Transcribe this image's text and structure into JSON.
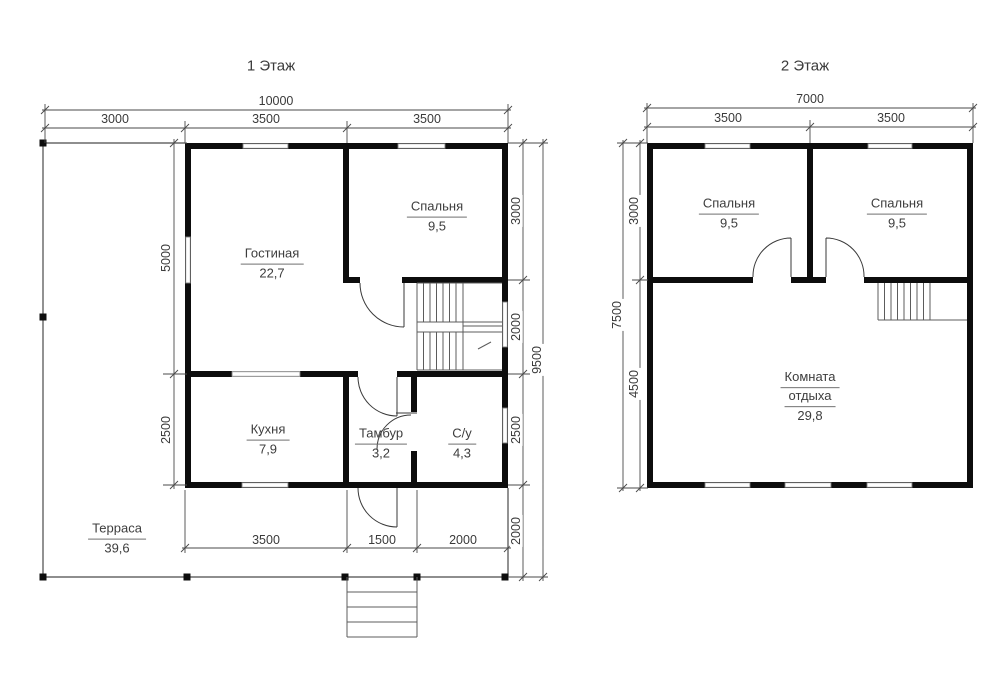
{
  "floor1": {
    "title": "1 Этаж",
    "dims": {
      "total_width": "10000",
      "segments_top": [
        "3000",
        "3500",
        "3500"
      ],
      "left": [
        "5000",
        "2500"
      ],
      "right": [
        "3000",
        "2000",
        "2500",
        "2000"
      ],
      "total_height": "9500",
      "segments_bottom": [
        "3500",
        "1500",
        "2000"
      ]
    },
    "rooms": {
      "living": {
        "name": "Гостиная",
        "area": "22,7"
      },
      "bedroom": {
        "name": "Спальня",
        "area": "9,5"
      },
      "kitchen": {
        "name": "Кухня",
        "area": "7,9"
      },
      "vestibule": {
        "name": "Тамбур",
        "area": "3,2"
      },
      "bathroom": {
        "name": "С/у",
        "area": "4,3"
      },
      "terrace": {
        "name": "Терраса",
        "area": "39,6"
      }
    }
  },
  "floor2": {
    "title": "2 Этаж",
    "dims": {
      "total_width": "7000",
      "segments_top": [
        "3500",
        "3500"
      ],
      "total_height": "7500",
      "left": [
        "3000",
        "4500"
      ]
    },
    "rooms": {
      "bedroom_left": {
        "name": "Спальня",
        "area": "9,5"
      },
      "bedroom_right": {
        "name": "Спальня",
        "area": "9,5"
      },
      "lounge": {
        "name_line1": "Комната",
        "name_line2": "отдыха",
        "area": "29,8"
      }
    }
  }
}
